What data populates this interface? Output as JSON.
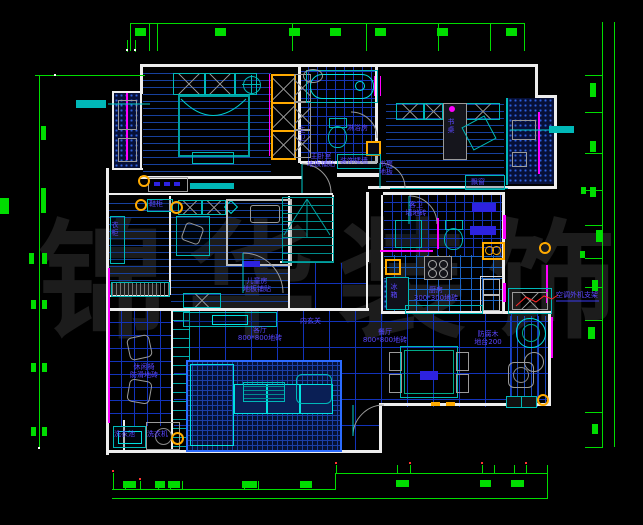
{
  "title": "residential floor plan",
  "watermark": "锦华装饰",
  "colors": {
    "background": "#000000",
    "dimension_green": "#00dd00",
    "wall_white": "#ededed",
    "fixture_cyan": "#00b8b8",
    "floor_grid_blue": "#1334c0",
    "label_blue": "#5a46ff",
    "accent_magenta": "#ff00ff",
    "wardrobe_orange": "#ffaa00",
    "ac_cable_red": "#ff2a2a",
    "watermark_gray": "#1c1c1c"
  },
  "labels": {
    "master_bedroom": [
      "主卧室",
      "地板铺贴"
    ],
    "master_bath": [
      "主卫",
      "墙地砖"
    ],
    "shower": "淋浴房",
    "wardrobe": "衣柜",
    "shoe_cabinet": "鞋柜",
    "kids_room": [
      "儿童房",
      "地板铺贴"
    ],
    "study": [
      "书房",
      "地板"
    ],
    "desk": "书桌",
    "bay_window": "飘窗",
    "deco_wall": "装饰矮墙",
    "inner_hall": "内玄关",
    "living_room": [
      "客厅",
      "800*800地砖"
    ],
    "dining_room": [
      "餐厅",
      "800*800地砖"
    ],
    "kitchen": [
      "厨房",
      "300*300地砖"
    ],
    "fridge": "冰箱",
    "guest_bath": [
      "客卫",
      "墙地砖"
    ],
    "deck_balcony": [
      "防腐木",
      "地台200"
    ],
    "ac_bracket": "空调外机支架",
    "laundry_sink": "洗衣池",
    "washing_machine": "洗衣机",
    "leisure_balcony": [
      "休闲椅",
      "防滑地砖"
    ]
  }
}
